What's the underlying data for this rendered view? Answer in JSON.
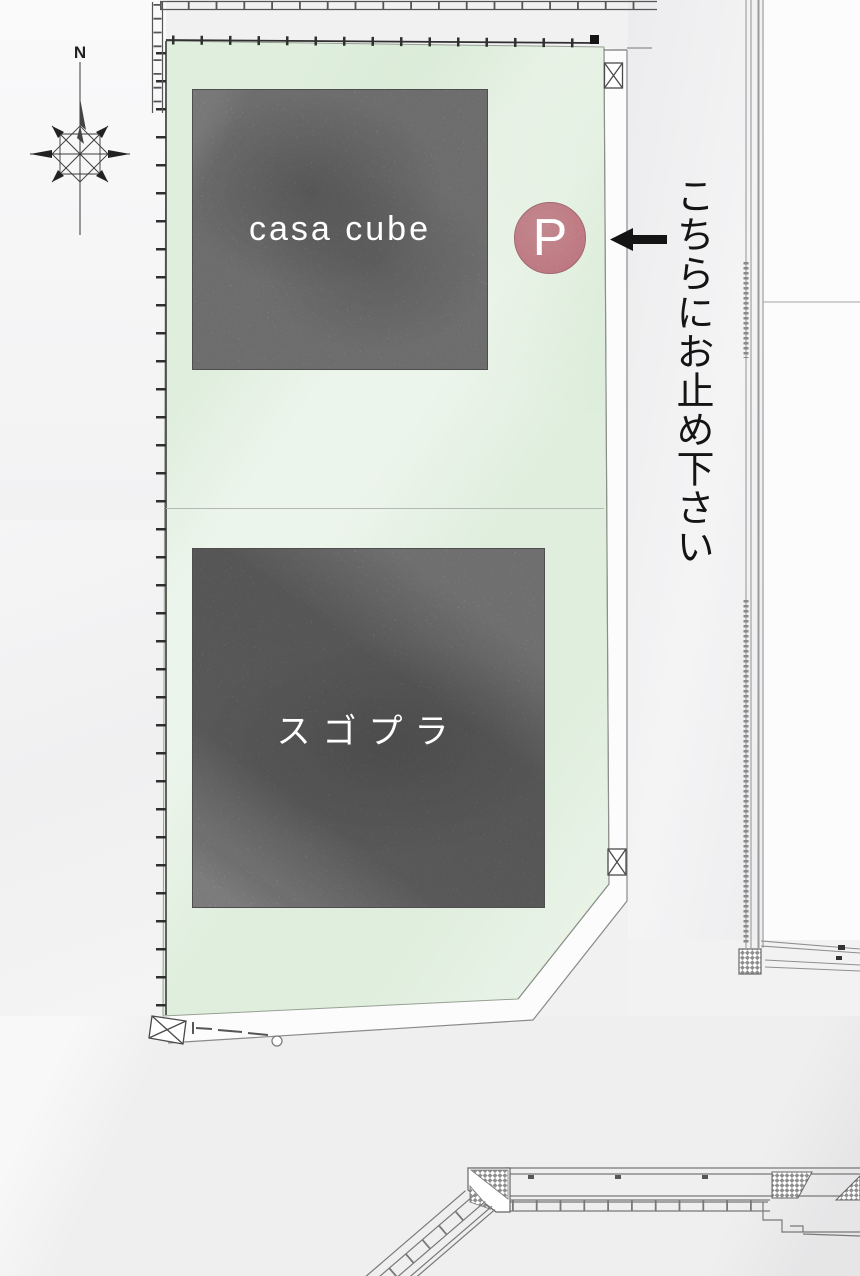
{
  "compass": {
    "north_label": "N"
  },
  "site": {
    "buildings": [
      {
        "label": "casa cube"
      },
      {
        "label": "スゴプラ"
      }
    ],
    "parking": {
      "badge_label": "P",
      "note": "こちらにお止め下さい"
    }
  },
  "icons": {
    "compass": "compass-rose",
    "parking_badge": "pink-circle-P",
    "arrow": "left-black-arrow"
  },
  "colors": {
    "site_green": "#dfeedd",
    "building_gray": "#9d9d9d",
    "parking_pink": "#ee98a3",
    "arrow_black": "#141414",
    "background_gray": "#f1f1f2",
    "line_gray": "#8a8a8a"
  }
}
